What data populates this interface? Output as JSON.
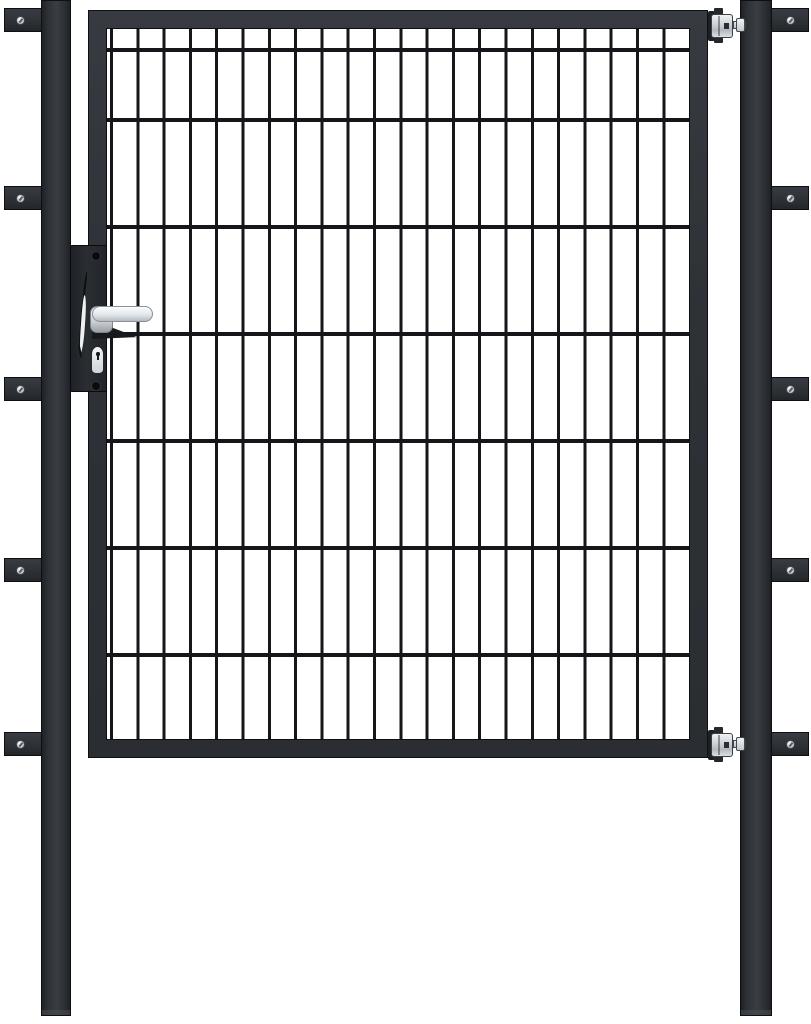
{
  "image": {
    "kind": "product-photo",
    "subject": "Anthracite single-leaf garden gate with double-wire mesh infill, hung between two square posts with wall-mount brackets, hinges on the right, lever handle and euro-profile cylinder lock on the left",
    "background_color": "#ffffff"
  },
  "colors": {
    "white": "#ffffff",
    "anthracite": "#2e3237",
    "anthracite-dark": "#17191c",
    "outline": "#0e0f11",
    "wire": "#141619",
    "silver": "#ccd1d6",
    "silver-bright": "#f2f4f6"
  },
  "structure": {
    "posts": 2,
    "wall_brackets_left": 5,
    "wall_brackets_right": 5,
    "bracket_screws": 10,
    "hinges": 2,
    "mesh": {
      "horizontal_wire_rows": 6,
      "vertical_wires": 22
    },
    "hardware": [
      "lever-handle",
      "lock-plate",
      "euro-cylinder-lock"
    ]
  }
}
